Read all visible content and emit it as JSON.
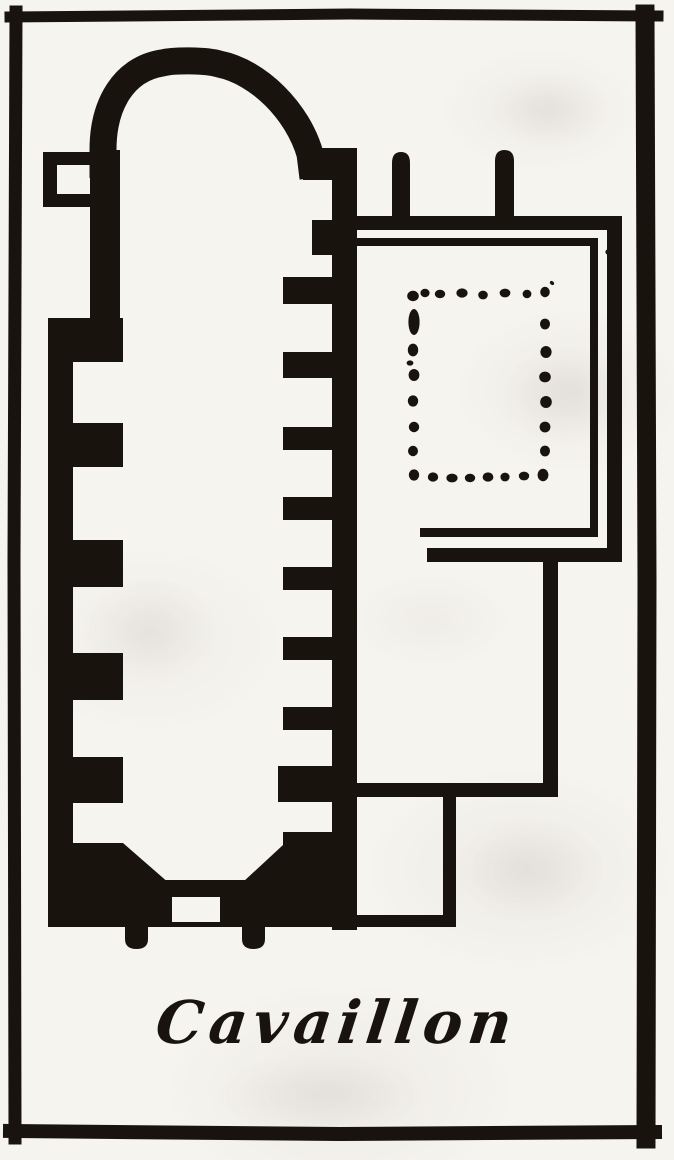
{
  "figure": {
    "caption": "Cavaillon",
    "kind": "engraved architectural floor plan",
    "parts": {
      "apse": "rounded apse at top of church",
      "nave": "long single nave with chapel recesses between wall stubs",
      "west_door": "doorway gap in bottom wall",
      "buttresses": "two small buttresses below west wall",
      "cloister": "double-walled cloister court at right",
      "cloister_columns": "dotted rectangle of column bases in cloister garth",
      "annex_rooms": "two annex rooms between nave and cloister"
    }
  },
  "colors": {
    "ink": "#19130d",
    "paper": "#f6f4ef"
  }
}
